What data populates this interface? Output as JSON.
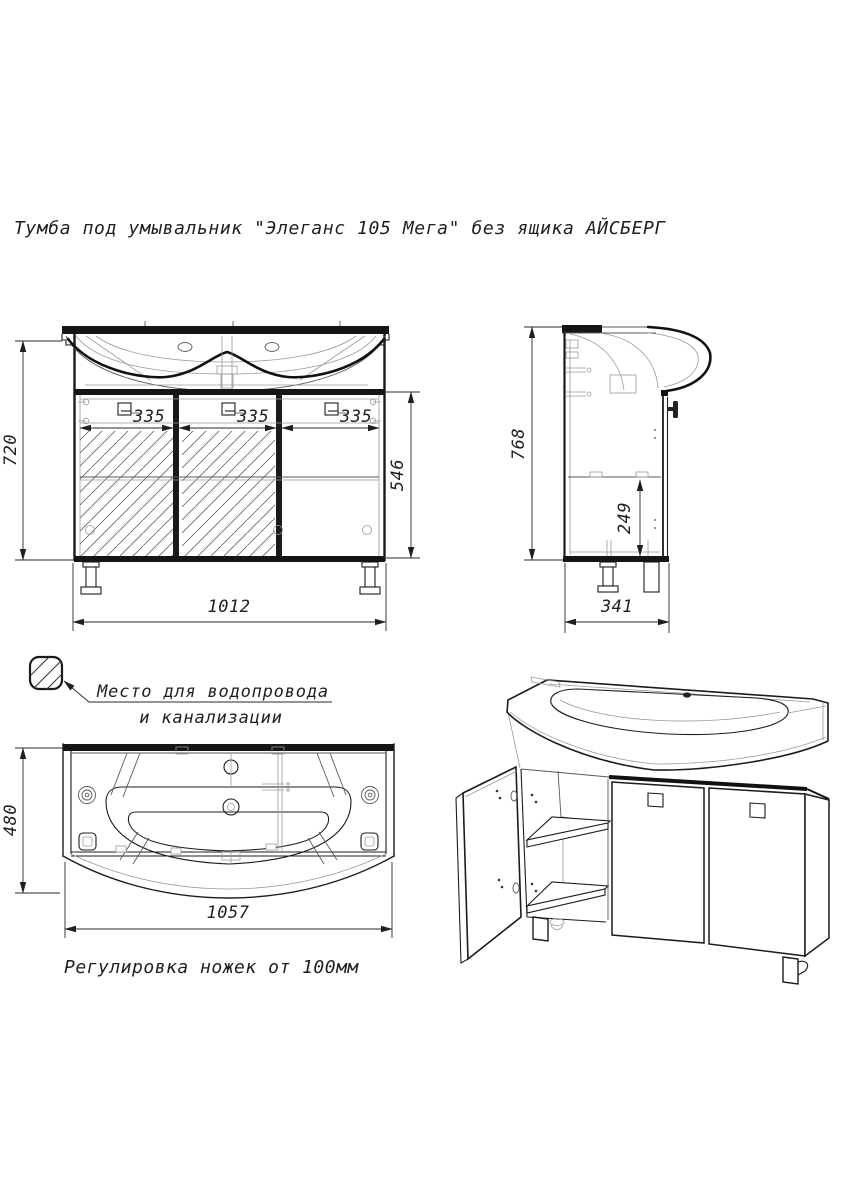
{
  "title": "Тумба под умывальник \"Элеганс 105 Мега\" без ящика АЙСБЕРГ",
  "front_view": {
    "dim_height": "720",
    "dim_door1": "335",
    "dim_door2": "335",
    "dim_door3": "335",
    "dim_door_height": "546",
    "dim_width": "1012"
  },
  "side_view": {
    "dim_height": "768",
    "dim_shelf_bottom": "249",
    "dim_depth": "341"
  },
  "plan_view": {
    "dim_depth": "480",
    "dim_width": "1057"
  },
  "legend": {
    "line1": "Место для водопровода",
    "line2": "и канализации"
  },
  "note": "Регулировка ножек от 100мм"
}
